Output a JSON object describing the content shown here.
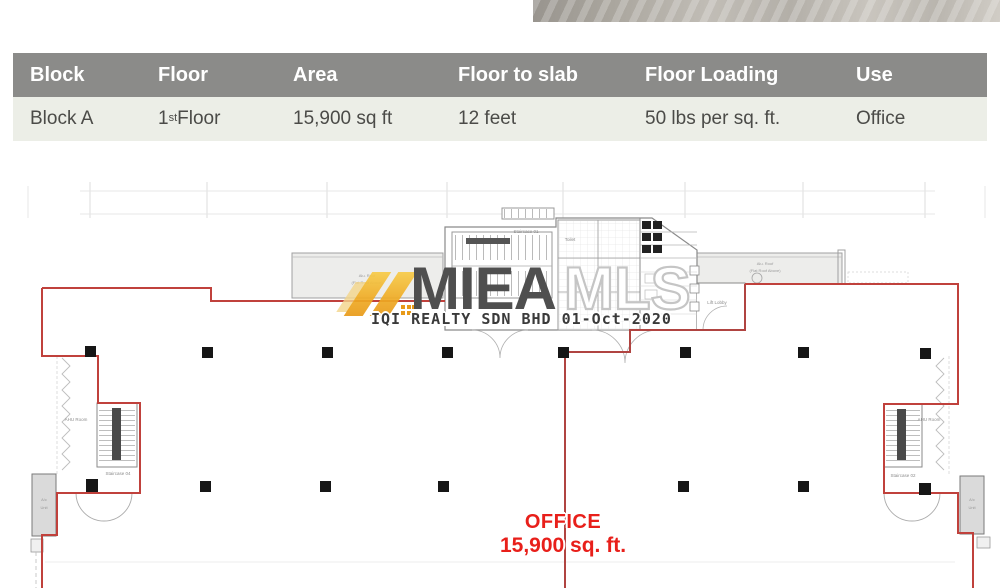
{
  "table": {
    "columns": [
      "Block",
      "Floor",
      "Area",
      "Floor to slab",
      "Floor Loading",
      "Use"
    ],
    "row": {
      "block": "Block A",
      "floor_num": "1",
      "floor_sup": "st",
      "floor_rest": " Floor",
      "area": "15,900 sq ft",
      "slab": "12 feet",
      "loading": "50 lbs per sq. ft.",
      "use": "Office"
    }
  },
  "plan": {
    "labels": {
      "staircase_top": "Staircase 01",
      "toilet": "Toilet",
      "lift_lobby": "Lift Lobby",
      "ahu_left": "AHU Room",
      "ahu_right": "AHU Room",
      "staircase_left": "Staircase 04",
      "staircase_right": "Staircase 02",
      "canopy_left_1": "Alu. Roof",
      "canopy_left_2": "(Flat Roof Above)",
      "canopy_right_1": "Alu. Roof",
      "canopy_right_2": "(Flat Roof Above)",
      "acbox_1": "A/c",
      "acbox_2": "Unit"
    },
    "office": {
      "line1": "OFFICE",
      "line2": "15,900 sq. ft."
    },
    "watermark": {
      "brand_dark": "MIEA",
      "brand_light": "MLS",
      "footer": "IQI REALTY SDN BHD 01-Oct-2020"
    },
    "colors": {
      "boundary_red": "#c0413c",
      "office_red": "#e81f1a",
      "table_header_bg": "#8b8b89",
      "table_row_bg": "#eceee7",
      "watermark_orange": "#efab24"
    }
  }
}
